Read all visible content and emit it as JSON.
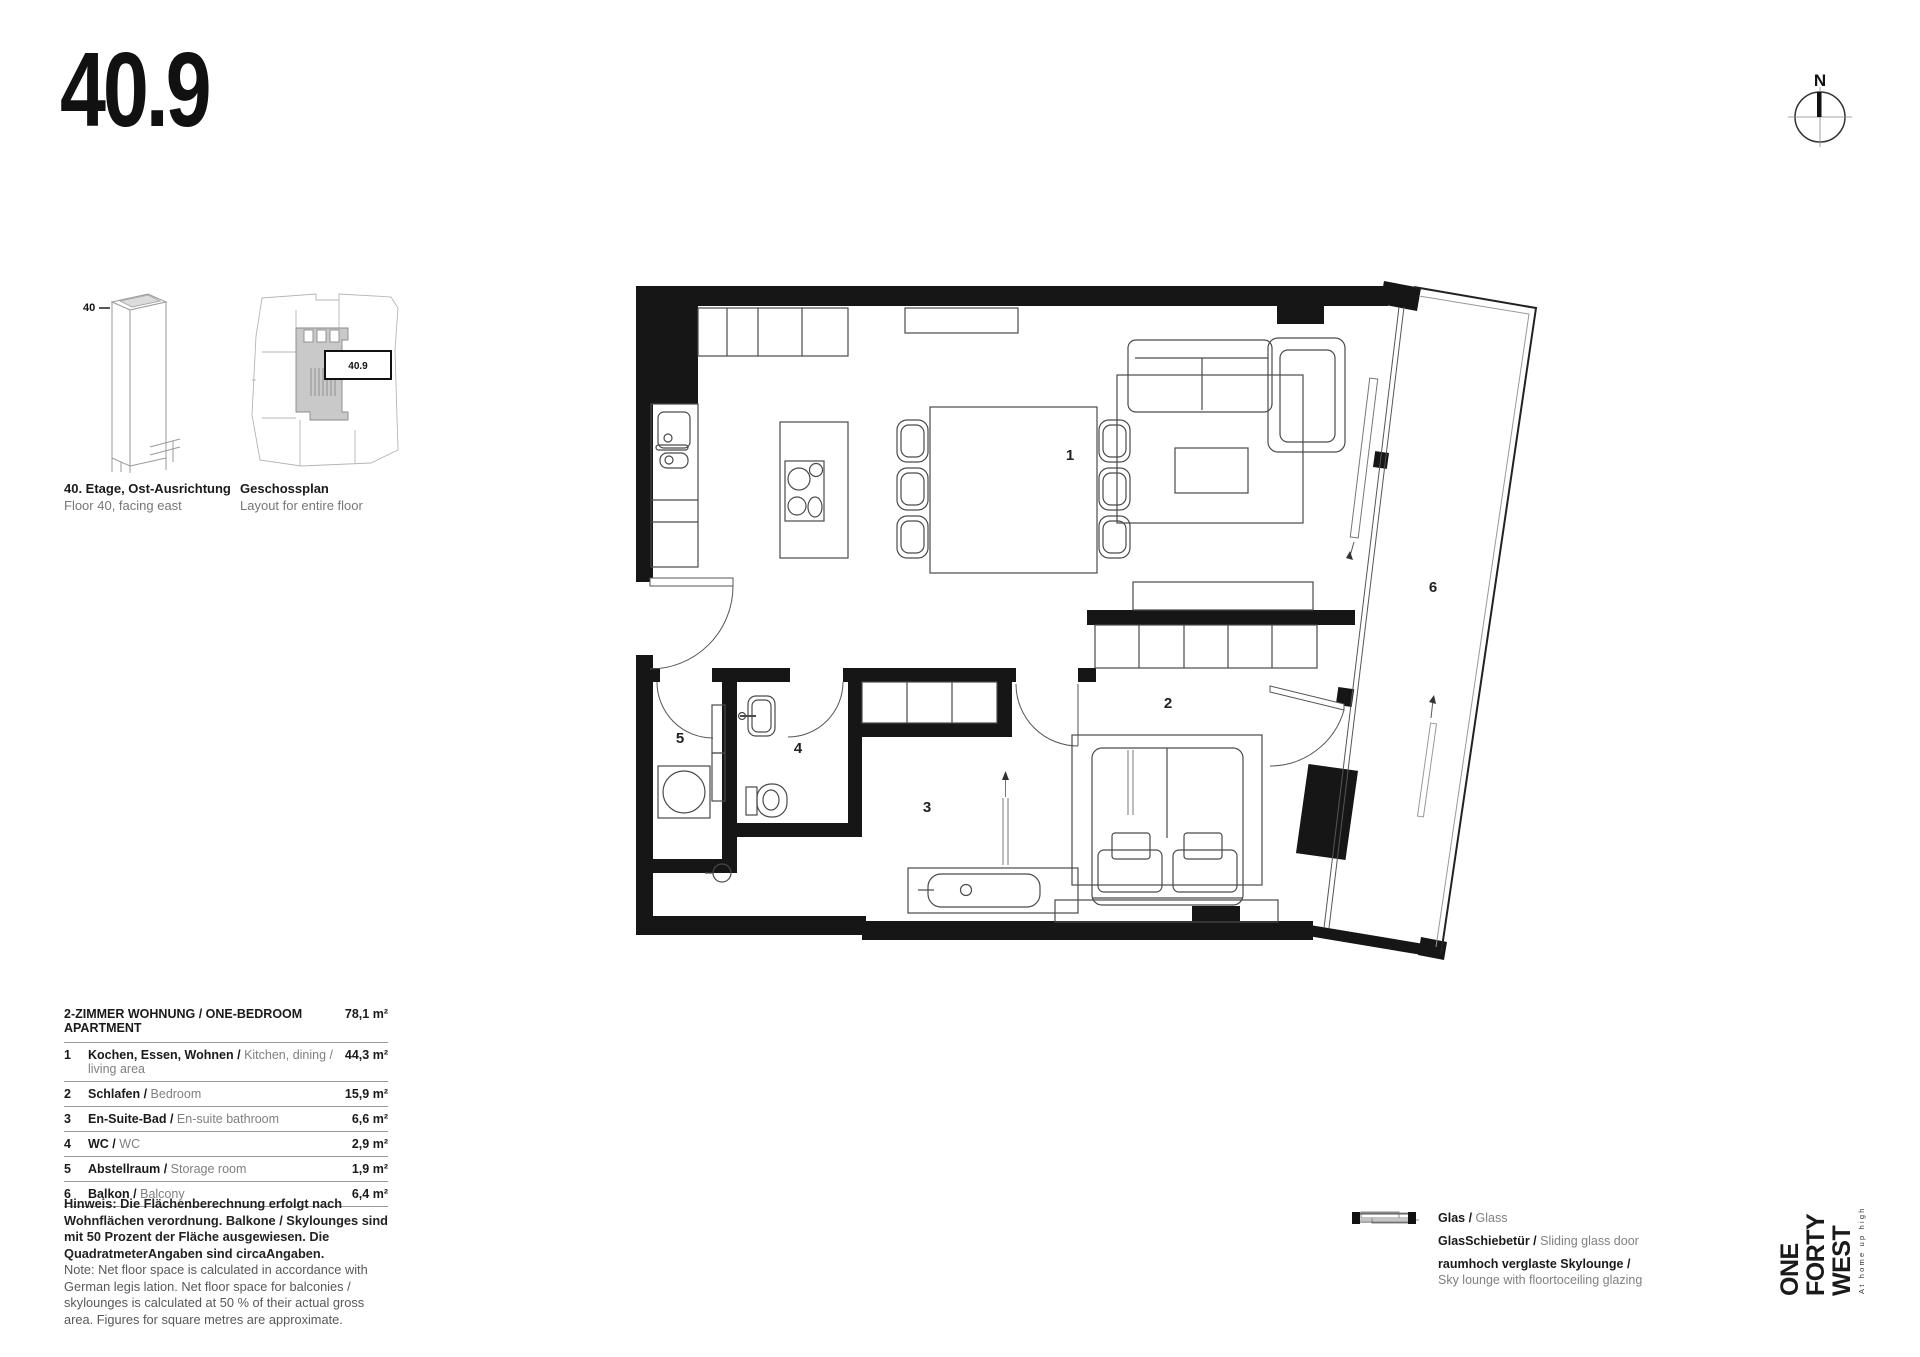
{
  "page": {
    "title": "40.9"
  },
  "compass": {
    "label": "N"
  },
  "diagrams": {
    "tower": {
      "floor_label": "40",
      "caption_de": "40. Etage, Ost-Ausrichtung",
      "caption_en": "Floor 40, facing east"
    },
    "floorplate": {
      "unit_label": "40.9",
      "caption_de": "Geschossplan",
      "caption_en": "Layout for entire floor"
    }
  },
  "apartment": {
    "header": "2-ZIMMER WOHNUNG / ONE-BEDROOM APARTMENT",
    "header_area": "78,1 m²",
    "rooms": [
      {
        "num": "1",
        "de": "Kochen, Essen, Wohnen /",
        "en": "Kitchen, dining / living area",
        "area": "44,3 m²"
      },
      {
        "num": "2",
        "de": "Schlafen /",
        "en": "Bedroom",
        "area": "15,9 m²"
      },
      {
        "num": "3",
        "de": "En-Suite-Bad /",
        "en": "En-suite bathroom",
        "area": "6,6 m²"
      },
      {
        "num": "4",
        "de": "WC /",
        "en": "WC",
        "area": "2,9 m²"
      },
      {
        "num": "5",
        "de": "Abstellraum /",
        "en": "Storage room",
        "area": "1,9 m²"
      },
      {
        "num": "6",
        "de": "Balkon /",
        "en": "Balcony",
        "area": "6,4 m²"
      }
    ]
  },
  "note": {
    "de": "Hinweis: Die Flächenberechnung erfolgt nach Wohnflächen verordnung. Balkone / Skylounges sind mit 50 Prozent der Fläche ausgewiesen. Die QuadratmeterAngaben sind circaAngaben.",
    "en": "Note: Net floor space is calculated in accordance with German legis lation. Net floor space for balconies / skylounges is calculated at 50 % of their actual gross area. Figures for square metres are approximate."
  },
  "legend": [
    {
      "de": "Glas /",
      "en": "Glass"
    },
    {
      "de": "GlasSchiebetür /",
      "en": "Sliding glass door"
    },
    {
      "de": "raumhoch verglaste Skylounge /",
      "en": "Sky lounge with floortoceiling glazing"
    }
  ],
  "logo": {
    "words": [
      "ONE",
      "FORTY",
      "WEST"
    ],
    "tagline": "At home up high"
  }
}
